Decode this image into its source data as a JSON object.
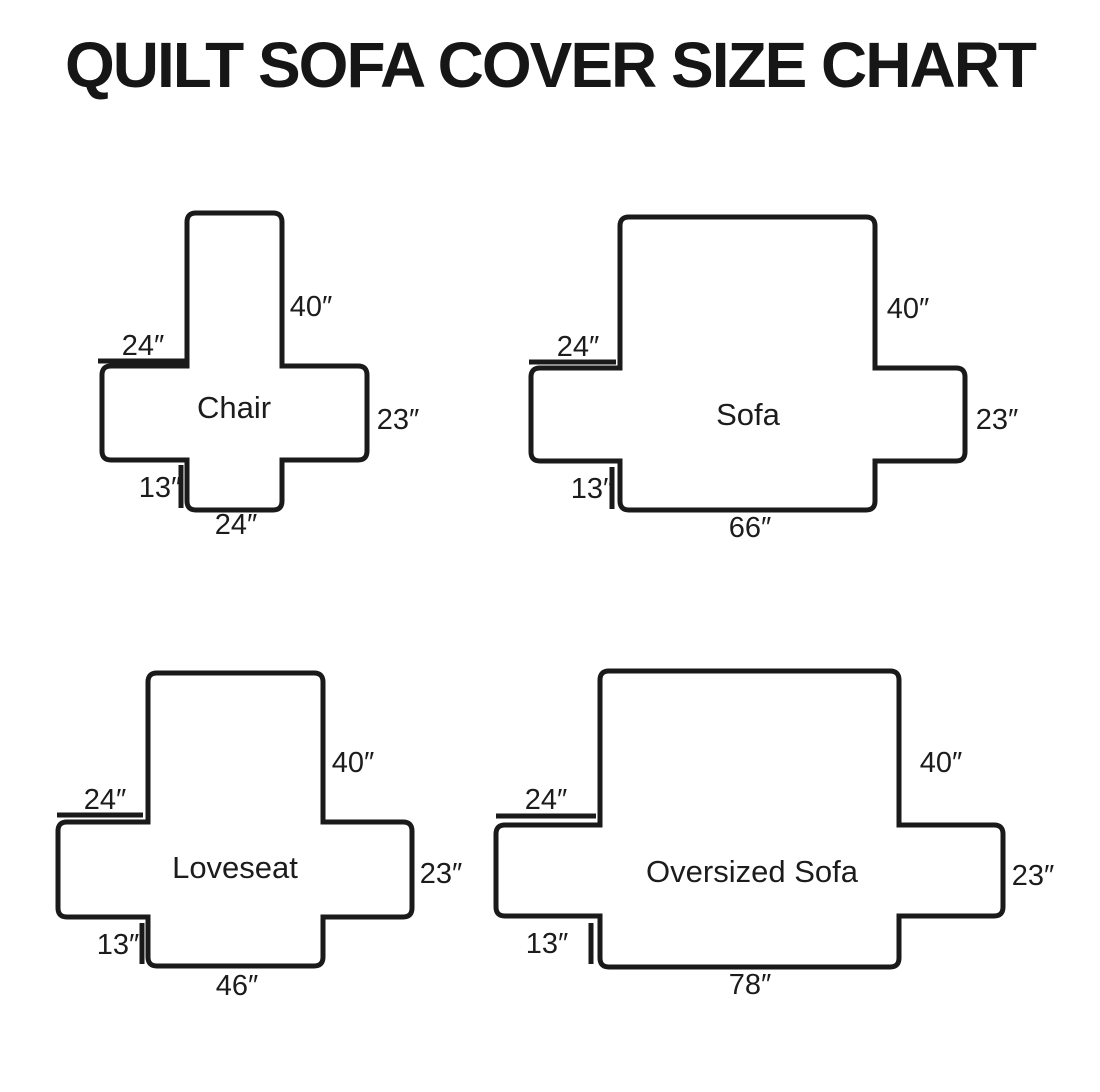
{
  "title": "QUILT SOFA COVER SIZE CHART",
  "colors": {
    "ink": "#1a1a1a",
    "background": "#ffffff"
  },
  "diagrams": [
    {
      "name": "Chair",
      "back_height": "40″",
      "arm_top_width": "24″",
      "side_width": "23″",
      "flap_height": "13″",
      "bottom_width": "24″"
    },
    {
      "name": "Sofa",
      "back_height": "40″",
      "arm_top_width": "24″",
      "side_width": "23″",
      "flap_height": "13″",
      "bottom_width": "66″"
    },
    {
      "name": "Loveseat",
      "back_height": "40″",
      "arm_top_width": "24″",
      "side_width": "23″",
      "flap_height": "13″",
      "bottom_width": "46″"
    },
    {
      "name": "Oversized Sofa",
      "back_height": "40″",
      "arm_top_width": "24″",
      "side_width": "23″",
      "flap_height": "13″",
      "bottom_width": "78″"
    }
  ]
}
